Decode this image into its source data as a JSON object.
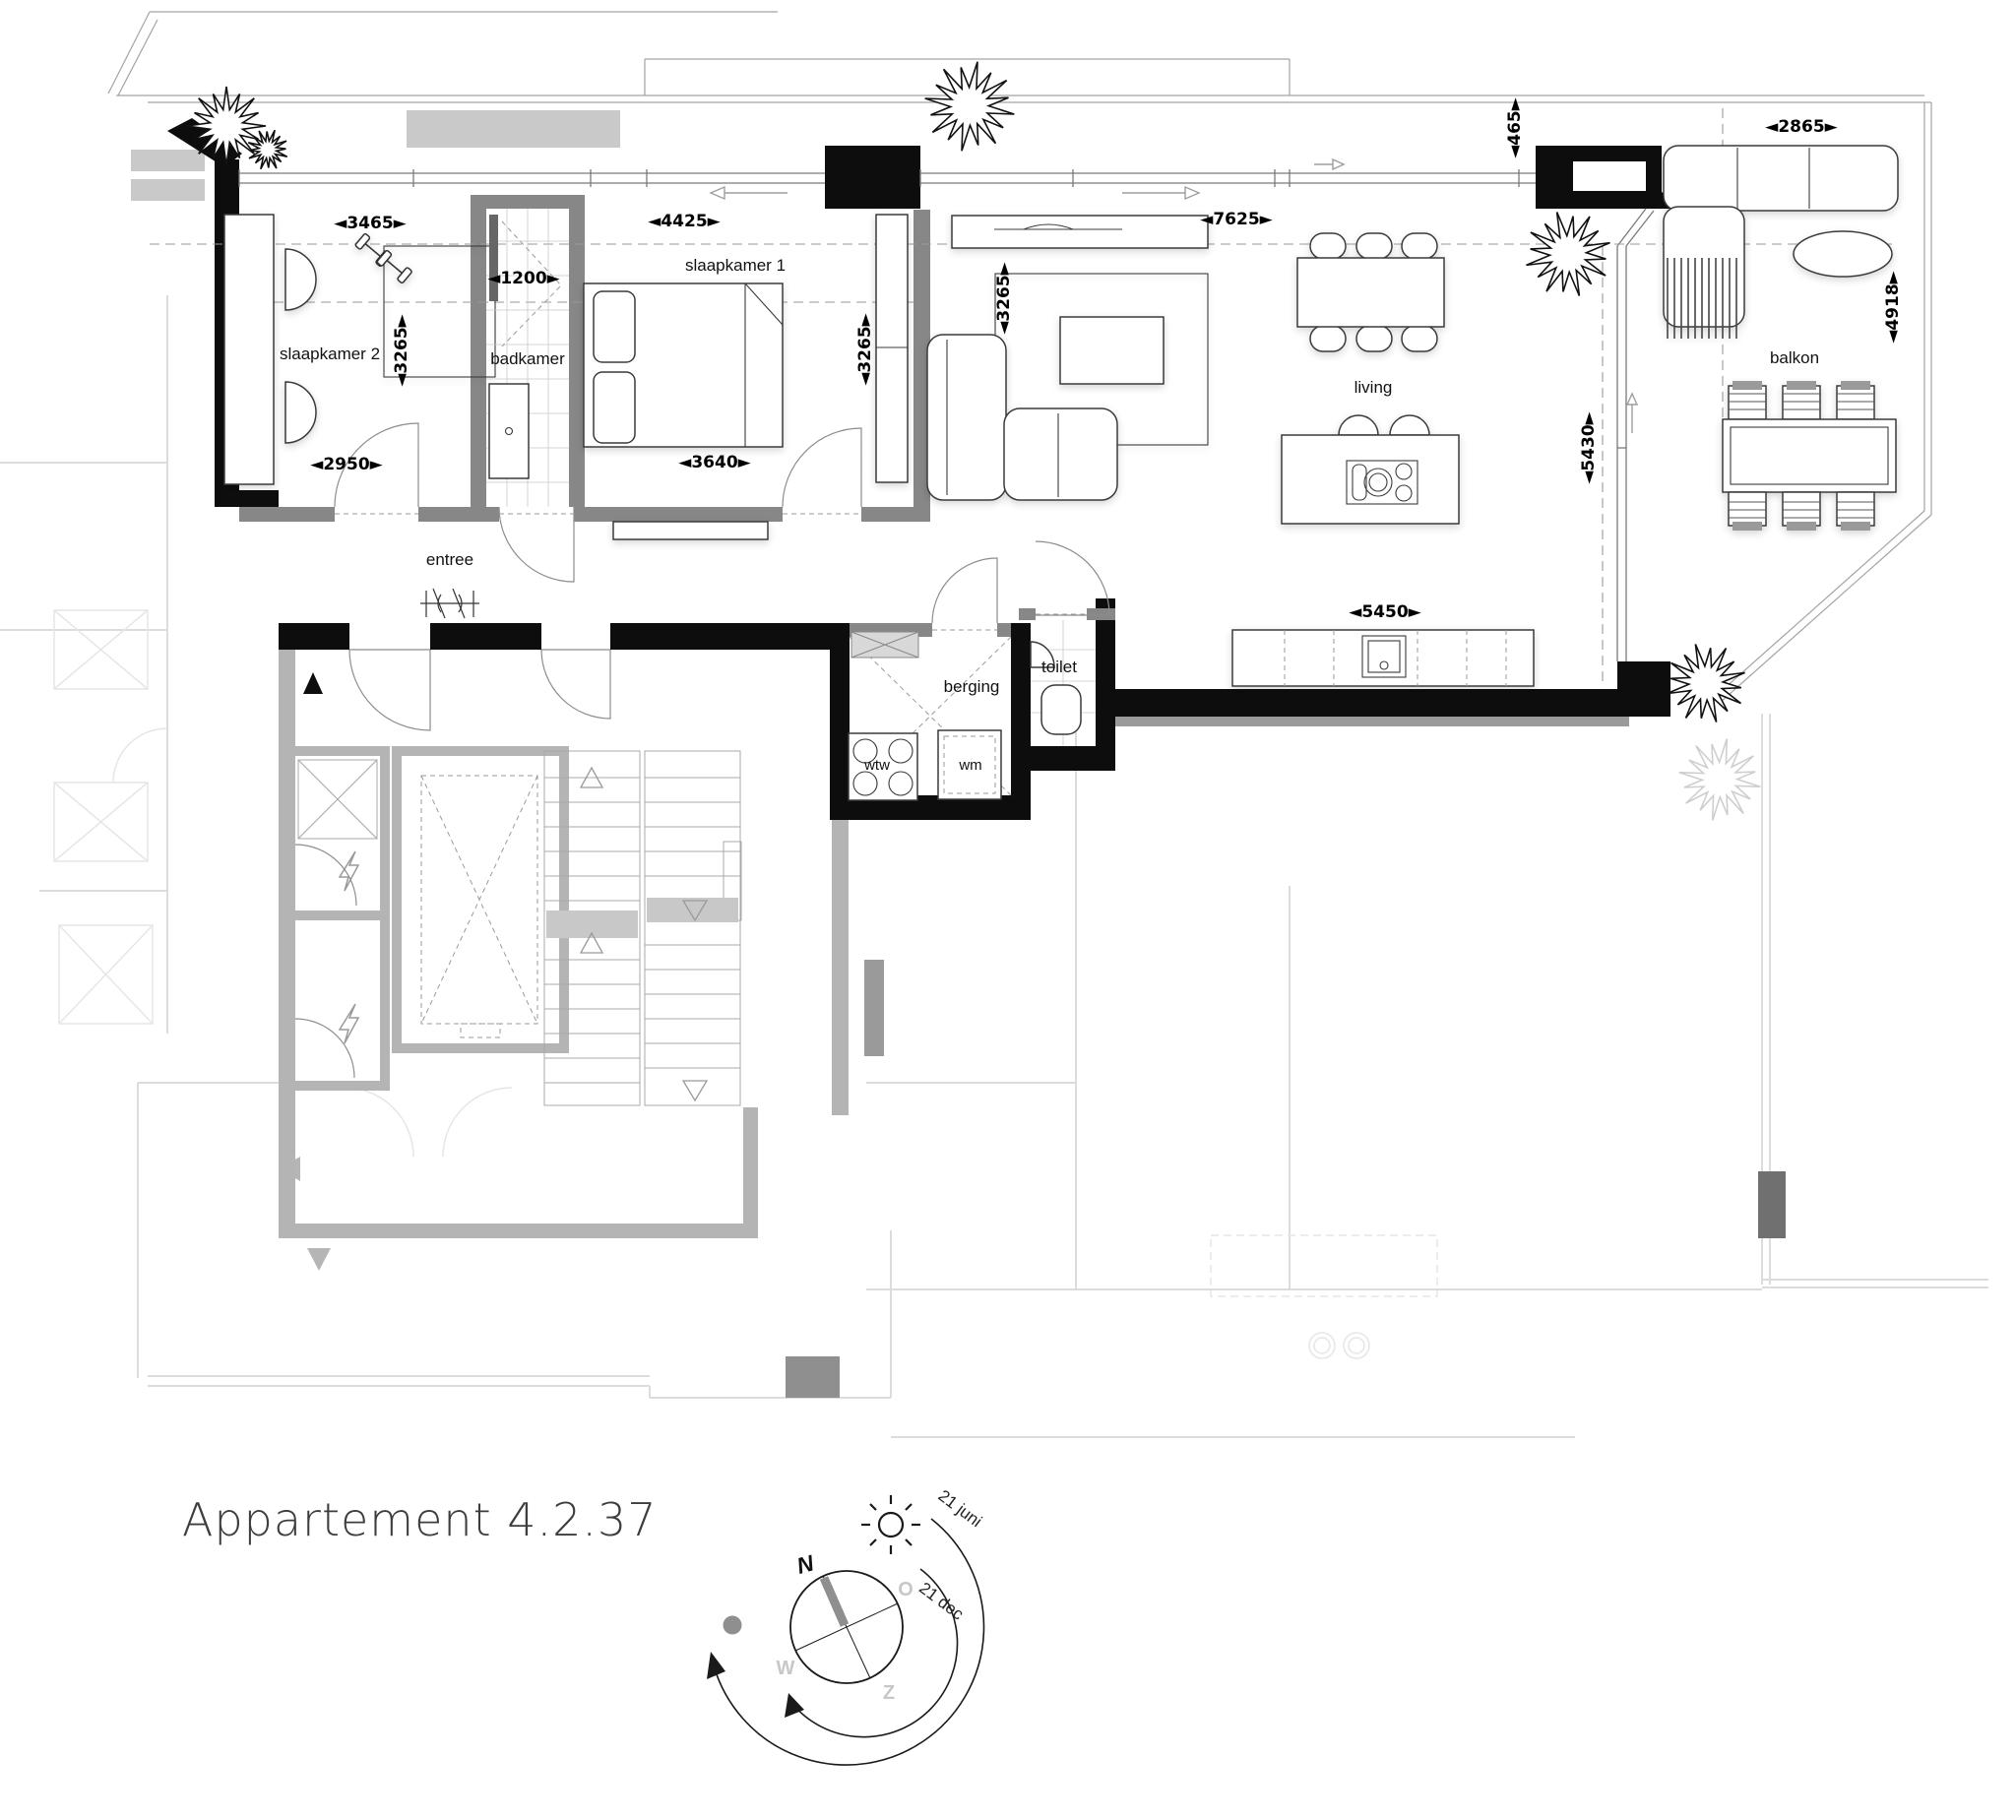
{
  "title": "Appartement 4.2.37",
  "rooms": {
    "slaapkamer2": "slaapkamer 2",
    "badkamer": "badkamer",
    "slaapkamer1": "slaapkamer 1",
    "entree": "entree",
    "berging": "berging",
    "toilet": "toilet",
    "living": "living",
    "balkon": "balkon"
  },
  "appliances": {
    "wtw": "wtw",
    "wm": "wm"
  },
  "dims": {
    "d3465": "◄3465►",
    "d4425": "◄4425►",
    "d1200": "◄1200►",
    "d3265": "◄3265►",
    "d2950": "◄2950►",
    "d3640": "◄3640►",
    "d7625": "◄7625►",
    "d5430": "◄5430►",
    "d5450": "◄5450►",
    "d465": "◄465►",
    "d2865": "◄2865►",
    "d4918": "◄4918►"
  },
  "compass": {
    "north": "N",
    "east": "O",
    "west": "W",
    "south": "Z",
    "summer": "21 juni",
    "winter": "21 dec"
  }
}
